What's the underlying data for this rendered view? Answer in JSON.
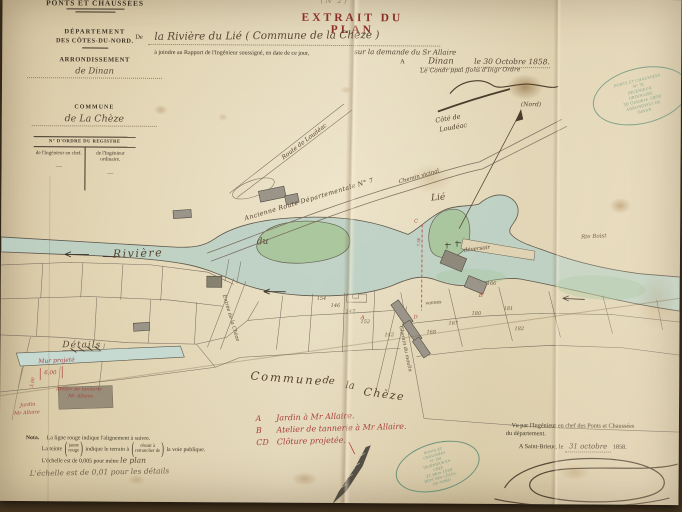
{
  "colors": {
    "paper": "#ddcfae",
    "backdrop": "#43331e",
    "red_ink": "#a8423c",
    "green_stamp": "#47806a",
    "river": "#b8d0c6",
    "island": "#a9c69b",
    "ink": "#584735",
    "printed_ink": "#3e3426",
    "title_red": "#8a2f26"
  },
  "letterhead": {
    "service": "PONTS ET CHAUSSÉES",
    "departement_label": "DÉPARTEMENT",
    "departement_value": "DES CÔTES-DU-NORD.",
    "arrondissement_label": "ARRONDISSEMENT",
    "arrondissement_value": "de Dinan",
    "commune_label": "COMMUNE",
    "commune_value": "de La Chèze",
    "registre_label": "N° D'ORDRE DU REGISTRE",
    "registre_col1": "de l'Ingénieur en chef.",
    "registre_col2": "de l'Ingénieur ordinaire.",
    "dash1": "—",
    "dash2": "—"
  },
  "header": {
    "page_note": "( N° 2 )",
    "title": "EXTRAIT DU PLAN",
    "subject_prefix": "De",
    "subject": "la Rivière du Lié ( Commune de la Chèze )",
    "attach_line": "à joindre au Rapport de l'Ingénieur soussigné, en date de ce jour,",
    "demande": "sur la demande du Sr Allaire",
    "place_prefix": "A",
    "place": "Dinan",
    "date_line": "le 30 Octobre 1858.",
    "signer_title": "Le Condr ppal ffons d'Ingr Ordre"
  },
  "stamps": {
    "top": {
      "l1": "PONTS ET CHAUSSÉES",
      "l2": "N° 78",
      "l3": "INGÉNIEUR ORDINAIRE",
      "l4": "30 Octobre 1858",
      "l5": "ARRONDISST DE DINAN"
    },
    "bottom": {
      "l1": "PONTS ET CHAUSSÉES",
      "l2": "N° 208",
      "l3": "INGÉNIEUR EN CHEF",
      "l4": "31 8bre 1858",
      "l5": "DÉPT DES CÔTES-DU-NORD"
    }
  },
  "map": {
    "north": "(Nord)",
    "cote_de": "Côté de",
    "loudeac": "Loudéac",
    "route_loudeac": "Route de Loudéac",
    "ancienne_route": "Ancienne Route Départementale N° 7",
    "chemin_vicinal": "Chemin vicinal",
    "riviere": "Rivière",
    "du": "du",
    "lie": "Lié",
    "deversoir": "déversoir",
    "vannes": "vannes",
    "rte_boist": "Rte Boist",
    "rue_entree": "Entrée de la Chèze",
    "chemin_moulin": "Chemin du moulin",
    "commune_w1": "Commune",
    "commune_w2": "de",
    "commune_w3": "la",
    "commune_w4": "Chèze",
    "parcels": [
      "154",
      "146",
      "147",
      "152",
      "142",
      "166",
      "180",
      "181",
      "182",
      "167",
      "168"
    ],
    "mark_a": "A",
    "mark_b": "B",
    "mark_c": "C",
    "mark_d": "D",
    "red_measure": "7,50"
  },
  "details": {
    "title": "Détails",
    "mur": "Mur projeté",
    "measure1": "6,00",
    "measure2": "3,00",
    "atelier_l1": "Atelier de tannerie",
    "atelier_l2": "Mr Allaire",
    "jardin_l1": "Jardin",
    "jardin_l2": "Mr Allaire"
  },
  "nota": {
    "label": "Nota.",
    "line1": "La ligne rouge indique l'alignement à suivre.",
    "teinte_pre": "La teinte",
    "opt1a": "jaune",
    "opt1b": "rouge",
    "teinte_mid": "indique le terrain à",
    "opt2a": "réunir à",
    "opt2b": "retrancher de",
    "teinte_post": "la voie publique.",
    "scale_printed": "L'échelle est de 0,005 pour mètre",
    "scale_hand": "le plan",
    "scale_details": "L'échelle est de 0,01 pour les détails"
  },
  "legend": {
    "a_key": "A",
    "a_text": "Jardin à Mr Allaire.",
    "b_key": "B",
    "b_text": "Atelier de tannerie à Mr Allaire.",
    "cd_key": "CD",
    "cd_text": "Clôture projetée."
  },
  "approval": {
    "line1": "Vu par l'Ingénieur en chef des Ponts et Chaussées",
    "line2": "du département.",
    "place_line": "A Saint-Brieuc, le",
    "date_hand": "31 octobre",
    "year": "1858."
  }
}
